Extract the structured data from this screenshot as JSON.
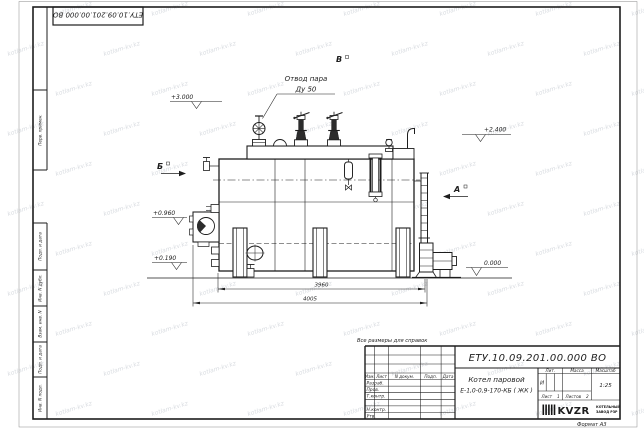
{
  "watermark": {
    "text": "kotlam-kv.kz"
  },
  "frame": {
    "top_stamp": "ЕТУ.10.09.201.00.000 ВО",
    "side_labels": {
      "perv_primen": "Перв. примен.",
      "podp_data_1": "Подп. и дата",
      "inv_dubl": "Инв. N дубл.",
      "vzam_inv": "Взам. инв. N",
      "podp_data_2": "Подп. и дата",
      "inv_podl": "Инв. N подл."
    },
    "format_label": "Формат А3"
  },
  "drawing": {
    "callout": {
      "line1": "Отвод пара",
      "line2": "Ду 50"
    },
    "views": {
      "top": "В",
      "side_left": "Б",
      "side_right": "А"
    },
    "elevations": {
      "e1": "+3.000",
      "e2": "+2.400",
      "e3": "+0.960",
      "e4": "+0.190",
      "e5": "0.000"
    },
    "dimensions": {
      "inner": "3960",
      "overall": "4005"
    }
  },
  "note": "Все размеры для справок",
  "title_block": {
    "doc_number": "ЕТУ.10.09.201.00.000 ВО",
    "product_name_1": "Котел паровой",
    "product_name_2": "Е-1,0-0,9-170-КБ ( ЖК )",
    "columns": {
      "izm": "Изм.",
      "list": "Лист",
      "n_dokum": "N докум.",
      "podp": "Подп.",
      "data": "Дата"
    },
    "rows": {
      "razrab": "Разраб.",
      "prov": "Пров.",
      "t_kontr": "Т.контр.",
      "n_kontr": "Н.контр.",
      "utv": "Утв."
    },
    "lit": {
      "header": "Лит.",
      "value": "И"
    },
    "massa": {
      "header": "Масса"
    },
    "masshtab": {
      "header": "Масштаб",
      "value": "1:25"
    },
    "sheet": {
      "label": "Лист",
      "value": "1"
    },
    "sheets": {
      "label": "Листов",
      "value": "2"
    },
    "logo": {
      "name": "KVZR",
      "sub1": "КОТЕЛЬНЫЙ",
      "sub2": "ЗАВОД РЗР"
    }
  }
}
